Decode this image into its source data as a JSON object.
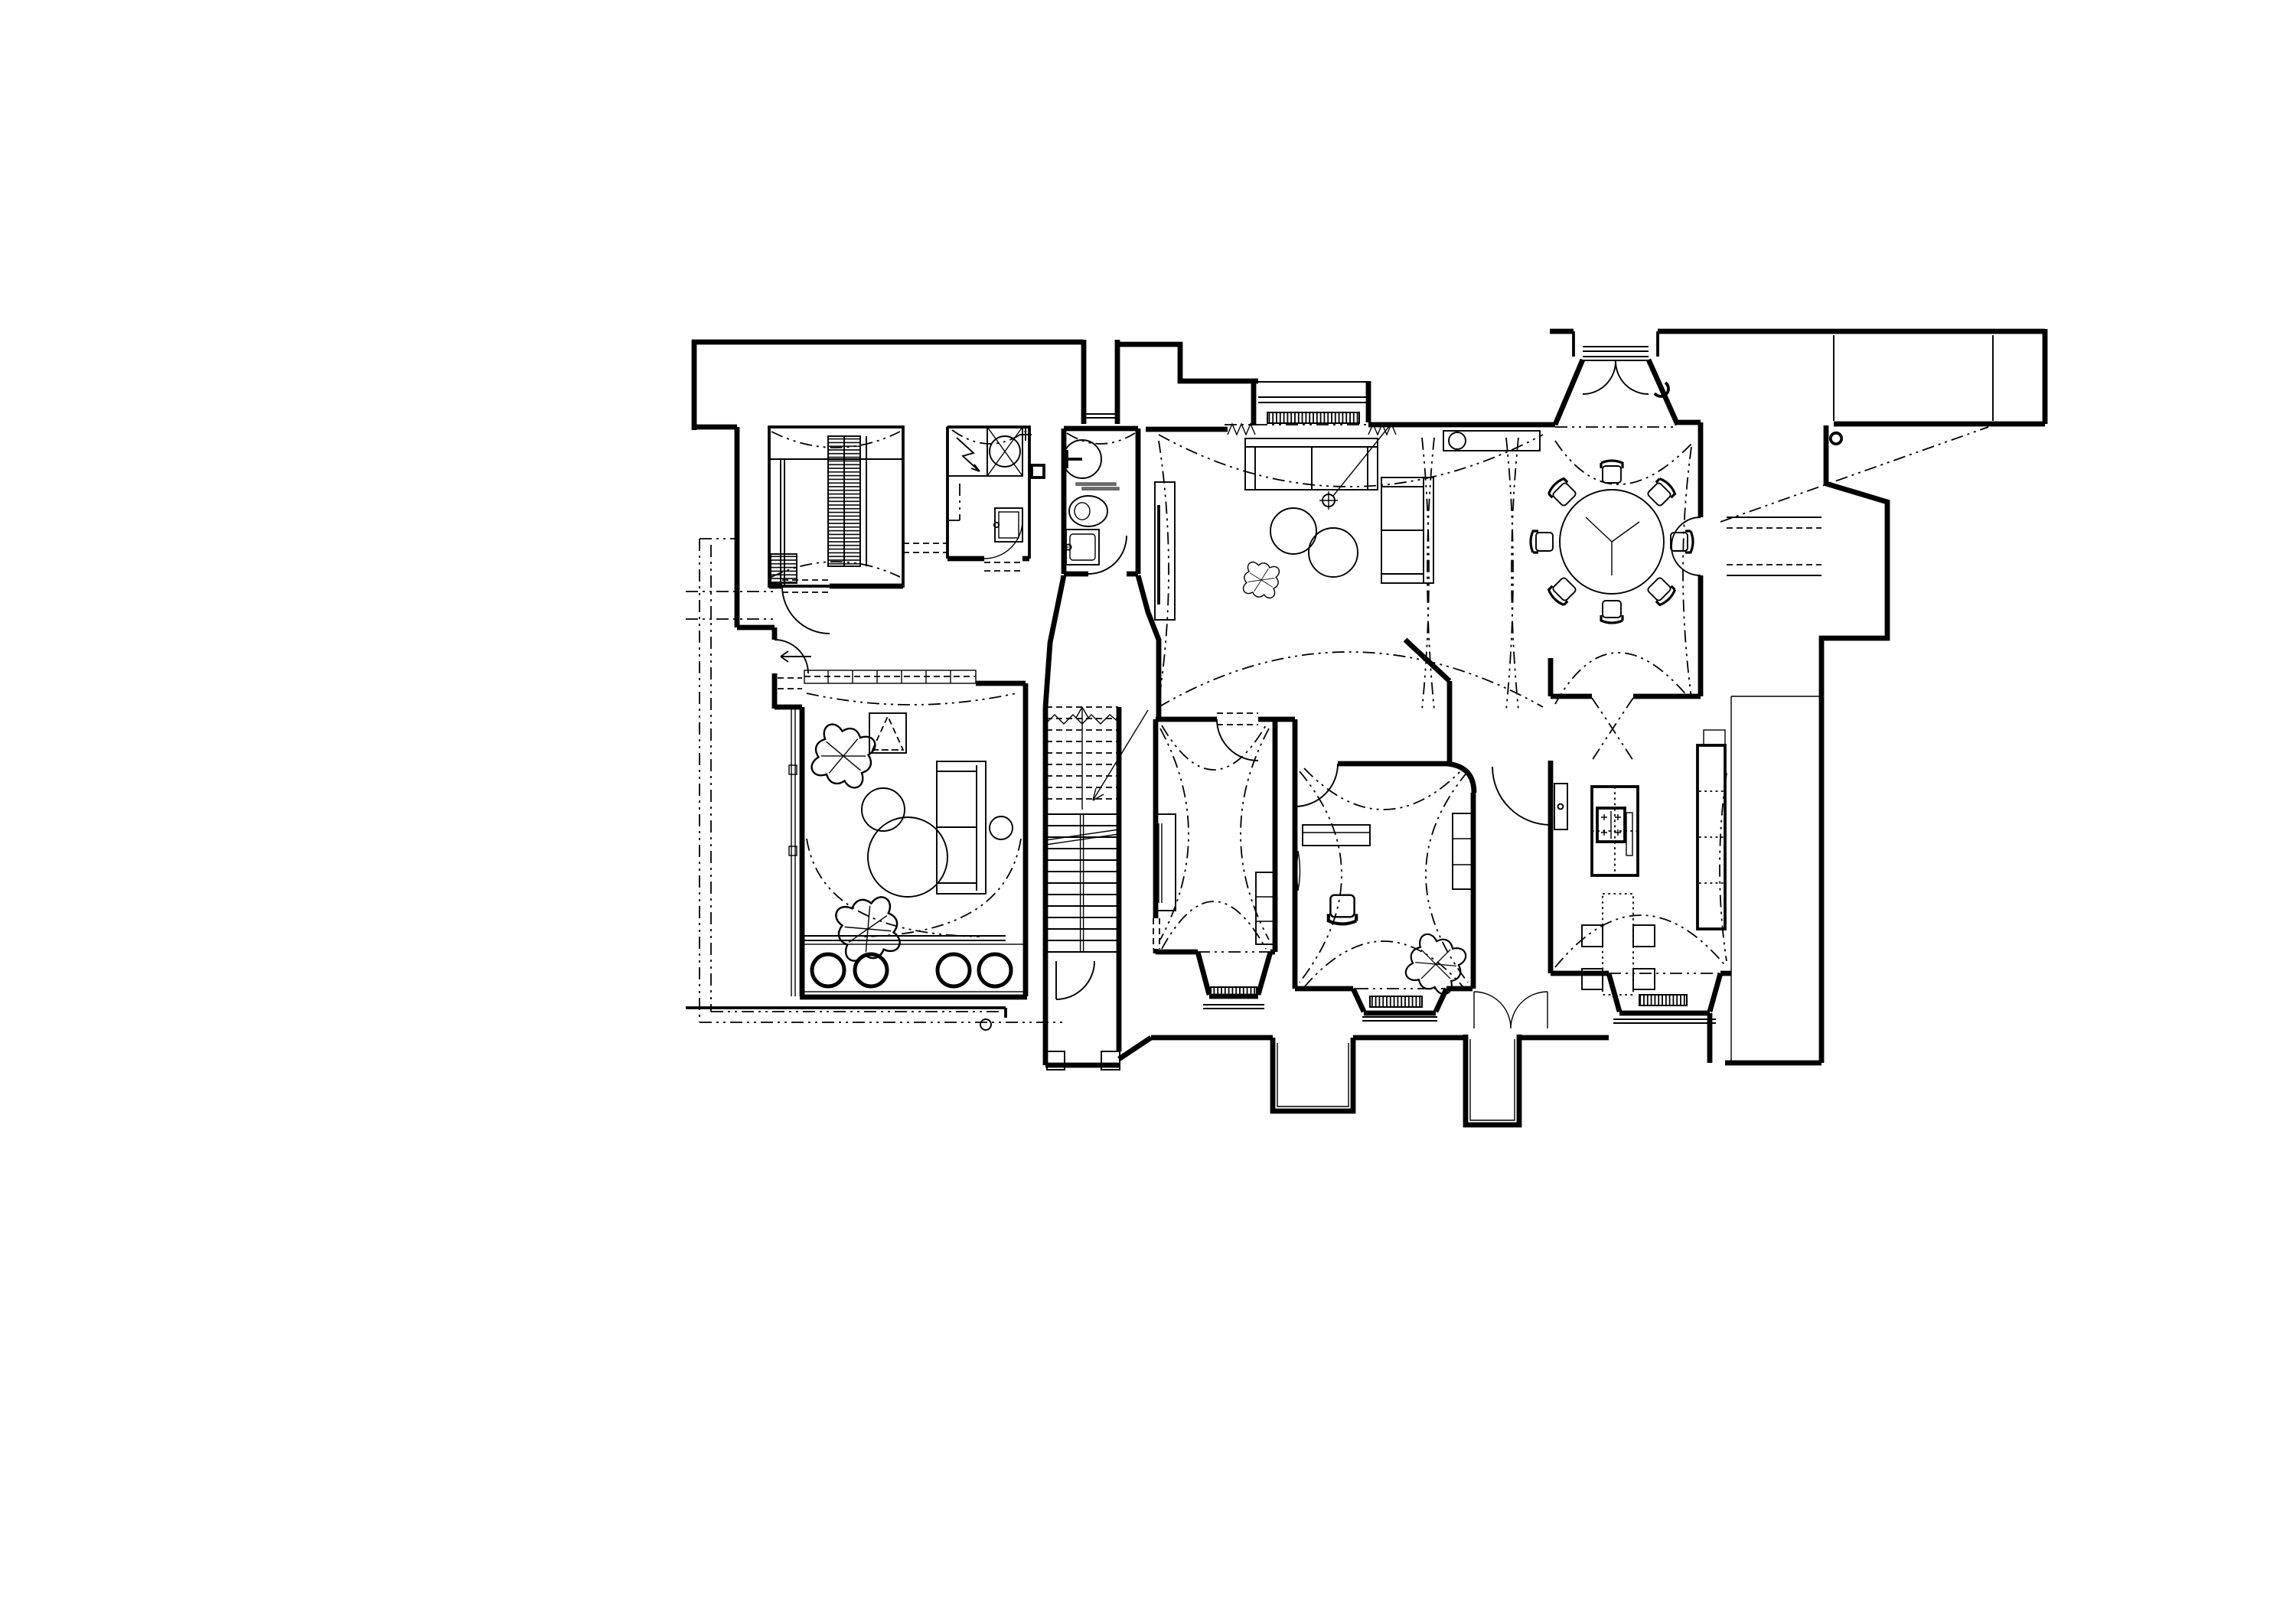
{
  "document": {
    "type": "architectural-floor-plan",
    "view": "ground floor plan, top-down CAD linework",
    "style": "black lines on white, thick walls, dash-dot vaulted ceiling projections",
    "visible_text": "none"
  },
  "colors": {
    "bg": "#ffffff",
    "line": "#000000",
    "line_soft": "#555555",
    "hatch": "#000000"
  },
  "rooms": [
    {
      "id": "walk-in-closet",
      "area": "top-left",
      "features": [
        "hatched wardrobe shelving",
        "shelf stack",
        "ceiling dash arcs",
        "door swing to hall"
      ]
    },
    {
      "id": "utility-room",
      "area": "top-left",
      "features": [
        "washer box with lightning arrow",
        "fan circle with X",
        "plus mark",
        "wall sink",
        "service shaft square"
      ]
    },
    {
      "id": "bathroom",
      "area": "top-center-left",
      "features": [
        "shower head",
        "gray glass shelf",
        "toilet",
        "washbasin with tap",
        "door swing"
      ]
    },
    {
      "id": "living-room",
      "area": "top-center",
      "features": [
        "window with radiator and curtain zigzags",
        "two sofas",
        "nesting round tables",
        "pouf",
        "tv sideboard",
        "ceiling light crosshair with leader",
        "vault lens dashes"
      ]
    },
    {
      "id": "entrance-vestibule",
      "area": "top-center",
      "features": [
        "splayed reveals",
        "double door with two swing arcs",
        "porch recess",
        "door-stop hook"
      ]
    },
    {
      "id": "dining-room",
      "area": "top-right-center",
      "features": [
        "round table with tripod lines",
        "8 chairs",
        "sideboard with lamp circle",
        "arched wall niche",
        "vault arcs"
      ]
    },
    {
      "id": "right-wing-room",
      "area": "top-right",
      "features": [
        "thick perimeter walls",
        "small round column",
        "diagonal ceiling dash line",
        "wall passage with arch"
      ]
    },
    {
      "id": "stair-hall",
      "area": "center-left",
      "features": [
        "up flight dashed treads",
        "break zigzag",
        "direction arrows",
        "handrail",
        "lower flight solid treads",
        "door swing",
        "porch plinths"
      ]
    },
    {
      "id": "hallway-room",
      "area": "center",
      "features": [
        "tall wall unit",
        "side cabinet",
        "hourglass vault dashes",
        "window bay with radiator"
      ]
    },
    {
      "id": "study-room",
      "area": "center-bottom",
      "features": [
        "desk",
        "desk chair",
        "cabinet",
        "pouf",
        "window bay with radiator",
        "vault arches"
      ]
    },
    {
      "id": "kitchen",
      "area": "right-bottom",
      "features": [
        "island with 4-burner hob",
        "table with 4 stools",
        "tall cabinet run with dashed shelves",
        "wall cabinet",
        "double french door",
        "window bay with radiator"
      ]
    },
    {
      "id": "family-room",
      "area": "bottom-left",
      "features": [
        "two poufs",
        "dashed play tent",
        "sofa with side table circle",
        "two round tables",
        "low dashed cabinet row",
        "planter band with four bold pots",
        "fence line",
        "side exit door with arrow"
      ]
    },
    {
      "id": "terrace",
      "area": "left-bottom outside",
      "features": [
        "dash-dot boundary rectangle",
        "thick edge line",
        "small drain circle"
      ]
    }
  ],
  "symbols": [
    {
      "id": "door-swing-arc",
      "meaning": "door opening direction"
    },
    {
      "id": "radiator-hatch",
      "meaning": "radiator under window"
    },
    {
      "id": "vault-dash",
      "meaning": "vaulted ceiling projection (dash-dot)"
    },
    {
      "id": "opening-dash-pair",
      "meaning": "unframed opening through wall"
    },
    {
      "id": "zigzag",
      "meaning": "curtain / flexible connection at window ends"
    }
  ],
  "counts": {
    "dining_chairs": 8,
    "kitchen_stools": 4,
    "planter_pots": 4,
    "poufs": 4,
    "sofas": 3,
    "radiators": 4
  }
}
